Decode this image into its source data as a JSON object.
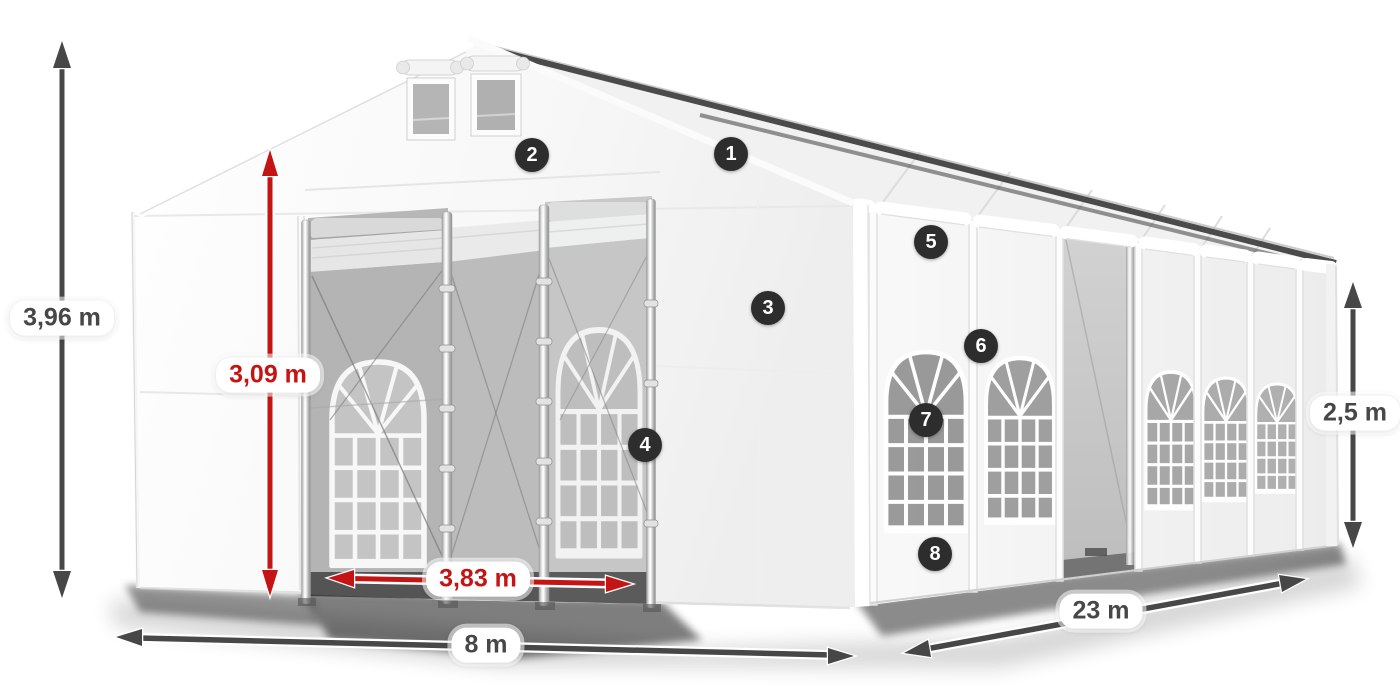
{
  "diagram": {
    "description": "White marquee tent with dimension annotations",
    "colors": {
      "dimension_gray": "#474747",
      "dimension_red": "#c41414",
      "badge_background": "#2d2d2d",
      "badge_text": "#ffffff",
      "label_background": "#ffffff"
    },
    "dimension_labels": {
      "total_height": "3,96 m",
      "entrance_height": "3,09 m",
      "entrance_width": "3,83 m",
      "tent_width": "8 m",
      "tent_length": "23 m",
      "side_height": "2,5 m"
    },
    "callout_badges": [
      {
        "number": "1"
      },
      {
        "number": "2"
      },
      {
        "number": "3"
      },
      {
        "number": "4"
      },
      {
        "number": "5"
      },
      {
        "number": "6"
      },
      {
        "number": "7"
      },
      {
        "number": "8"
      }
    ]
  }
}
